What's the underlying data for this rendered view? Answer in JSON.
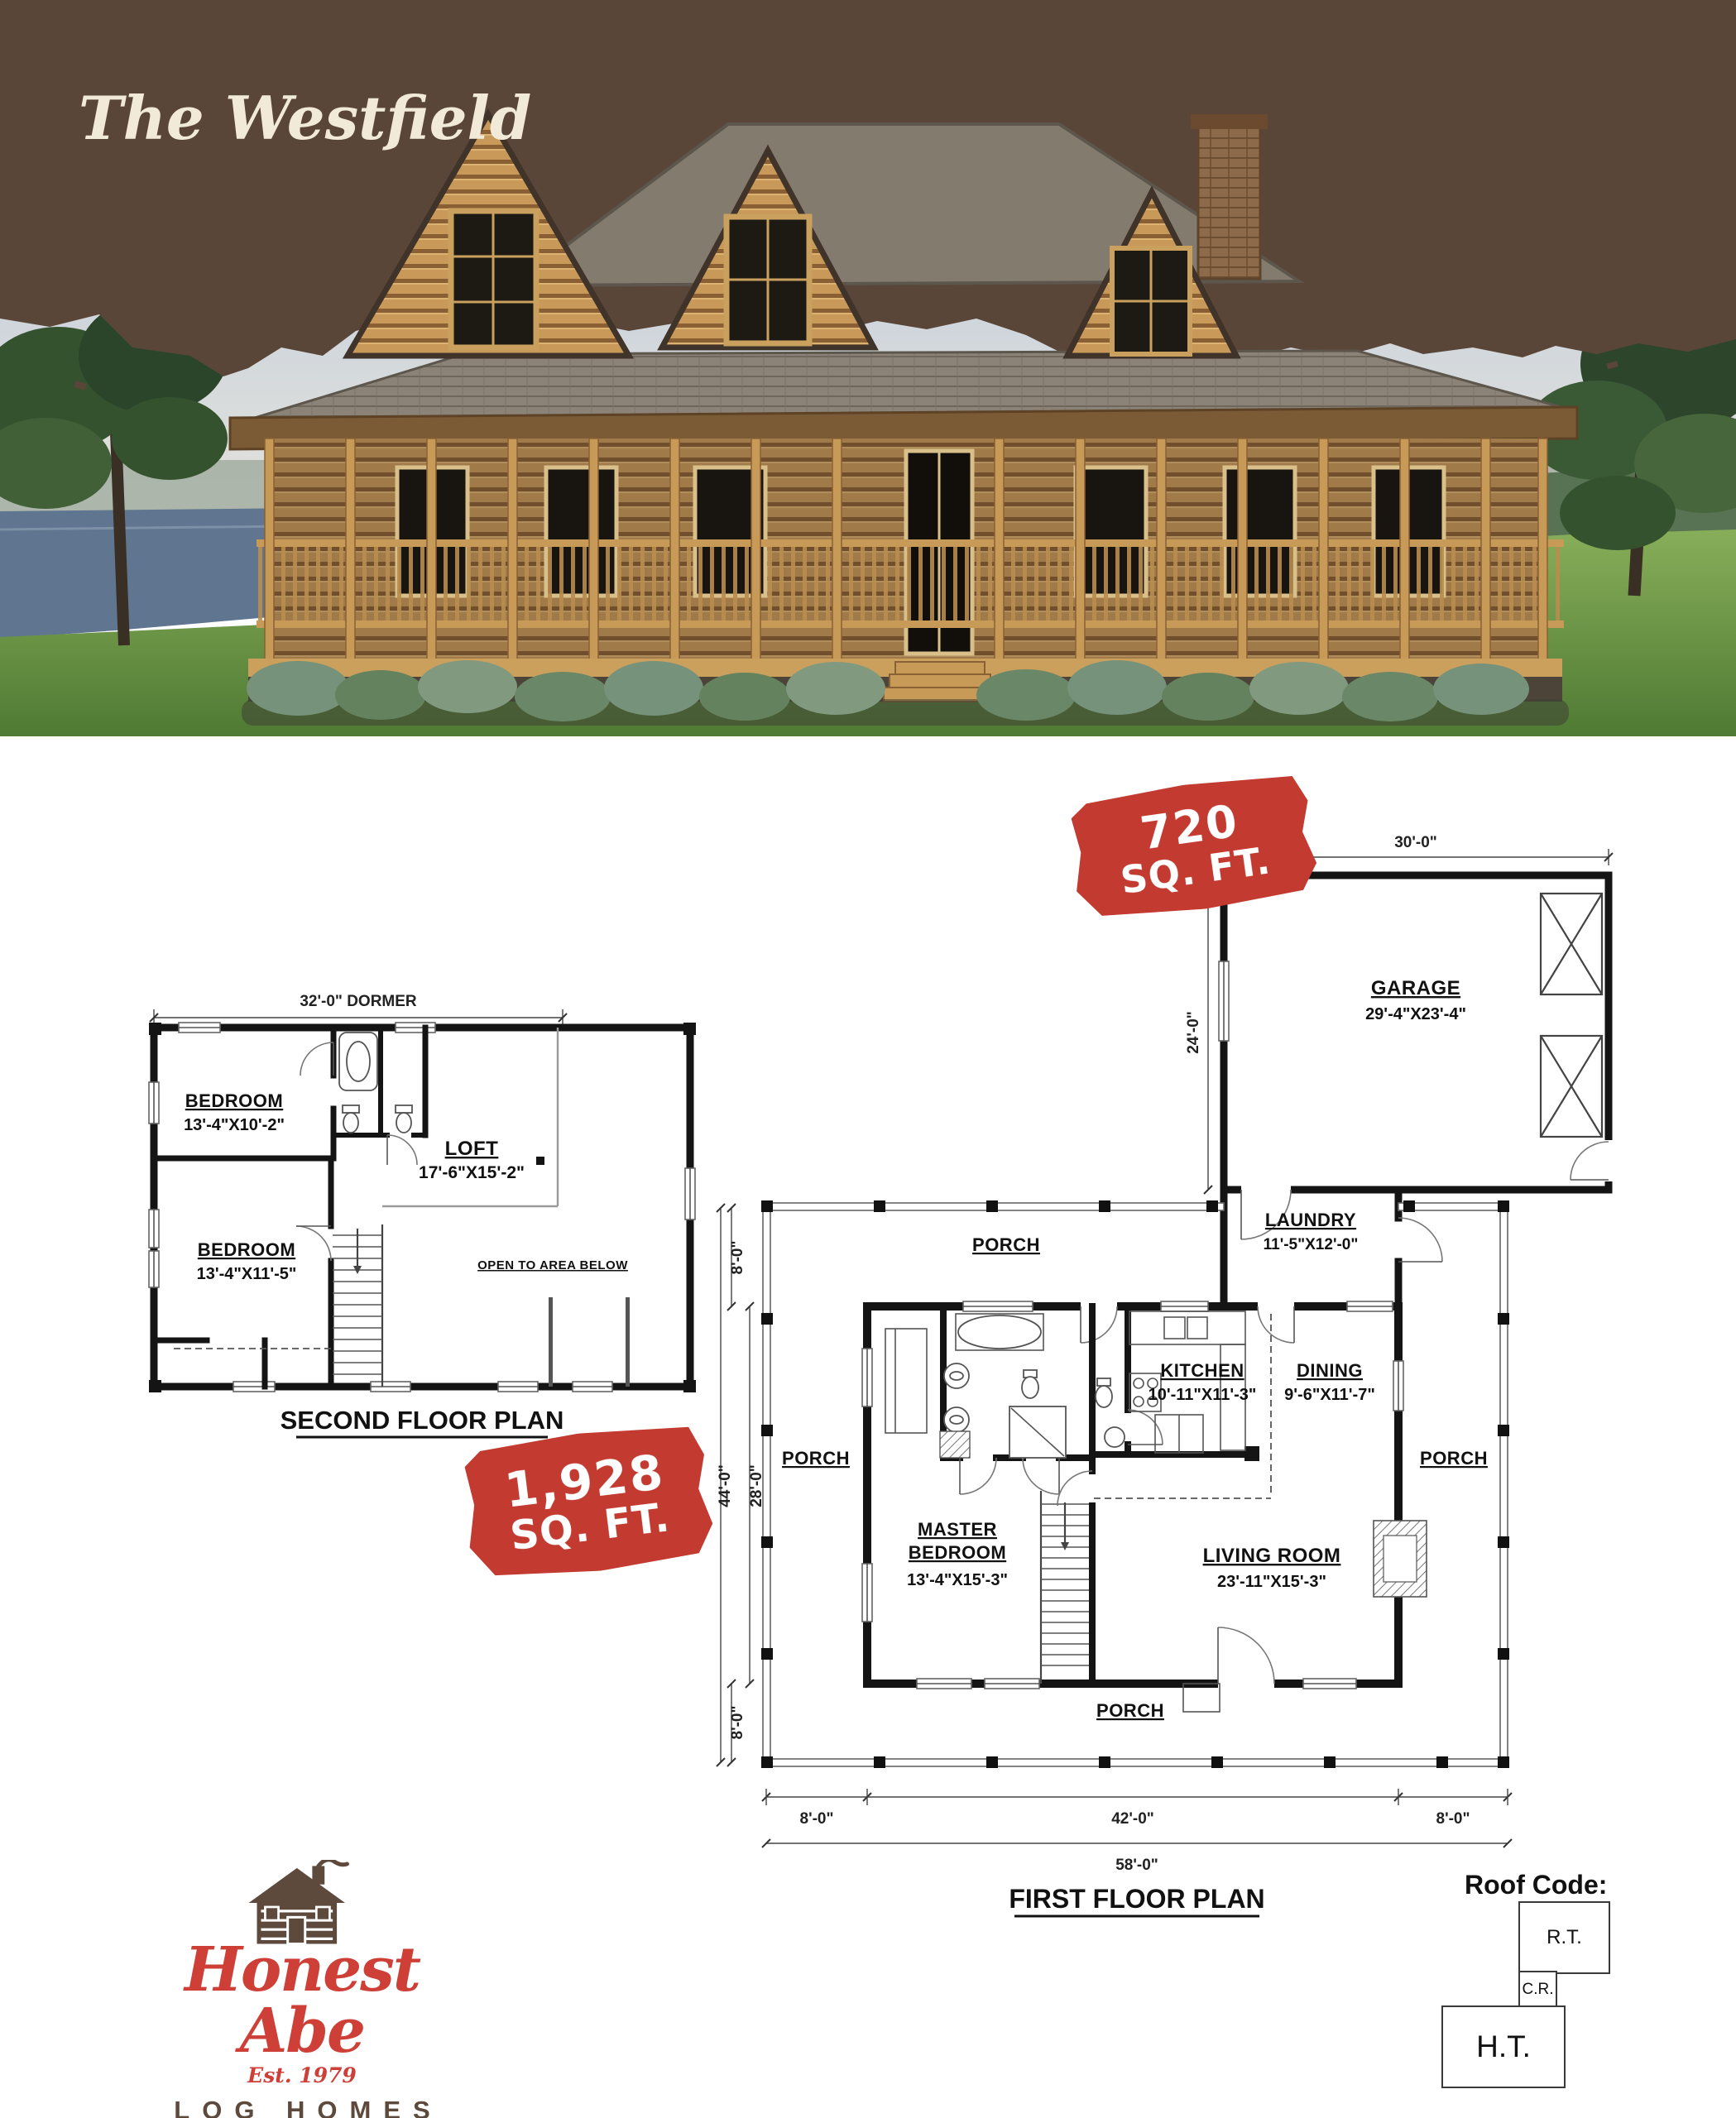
{
  "banner": {
    "title": "The Westfield"
  },
  "badges": {
    "garage": {
      "value": "720",
      "unit": "SQ. FT."
    },
    "main": {
      "value": "1,928",
      "unit": "SQ. FT."
    }
  },
  "second_floor": {
    "title": "SECOND FLOOR PLAN",
    "dim_dormer": "32'-0\" DORMER",
    "bedroom_top": {
      "name": "BEDROOM",
      "size": "13'-4\"X10'-2\""
    },
    "loft": {
      "name": "LOFT",
      "size": "17'-6\"X15'-2\""
    },
    "bedroom_bottom": {
      "name": "BEDROOM",
      "size": "13'-4\"X11'-5\""
    },
    "open_note": "OPEN TO AREA BELOW"
  },
  "first_floor": {
    "title": "FIRST FLOOR PLAN",
    "porch": "PORCH",
    "garage": {
      "name": "GARAGE",
      "size": "29'-4\"X23'-4\""
    },
    "laundry": {
      "name": "LAUNDRY",
      "size": "11'-5\"X12'-0\""
    },
    "kitchen": {
      "name": "KITCHEN",
      "size": "10'-11\"X11'-3\""
    },
    "dining": {
      "name": "DINING",
      "size": "9'-6\"X11'-7\""
    },
    "master": {
      "name_line1": "MASTER",
      "name_line2": "BEDROOM",
      "size": "13'-4\"X15'-3\""
    },
    "living": {
      "name": "LIVING ROOM",
      "size": "23'-11\"X15'-3\""
    },
    "dims": {
      "garage_width": "30'-0\"",
      "garage_depth": "24'-0\"",
      "porch_top": "8'-0\"",
      "overall_depth": "44'-0\"",
      "house_depth": "28'-0\"",
      "porch_bottom": "8'-0\"",
      "bottom_left_porch": "8'-0\"",
      "bottom_house": "42'-0\"",
      "bottom_right_porch": "8'-0\"",
      "bottom_overall": "58'-0\""
    }
  },
  "roof_code": {
    "label": "Roof Code:",
    "rt": "R.T.",
    "cr": "C.R.",
    "ht": "H.T."
  },
  "logo": {
    "brand": "Honest Abe",
    "est": "Est. 1979",
    "wordmark": "LOG HOMES"
  },
  "colors": {
    "banner_brown": "#5a4639",
    "cream": "#f2ead8",
    "badge_red": "#c23a30",
    "logo_red": "#ce4037",
    "logo_brown": "#5d4a3c"
  }
}
